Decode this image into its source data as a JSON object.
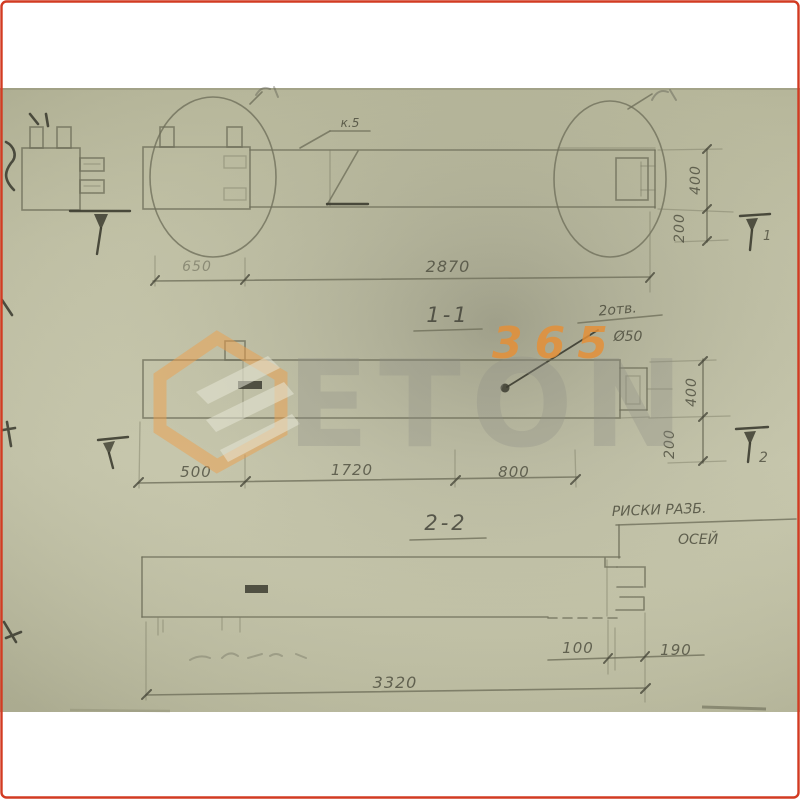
{
  "frame": {
    "border_color": "#d23b22"
  },
  "watermark": {
    "number": "365",
    "name": "ETON",
    "logo": "hexagon-logo",
    "accent_color": "#ee9f4b"
  },
  "elevation": {
    "callout_label": "к.5",
    "dim_left": "650",
    "dim_overall": "2870",
    "dim_height": "400",
    "dim_offset": "200",
    "cut_marker": "1"
  },
  "section_1_1": {
    "title": "1-1",
    "hole_note_top": "2отв.",
    "hole_note_bottom": "Ø50",
    "dim_1": "500",
    "dim_2": "1720",
    "dim_3": "800",
    "dim_height": "400",
    "dim_offset": "200",
    "cut_marker": "2"
  },
  "section_2_2": {
    "title": "2-2",
    "note_top": "РИСКИ РАЗБ.",
    "note_bottom": "ОСЕЙ",
    "dim_a": "100",
    "dim_b": "190",
    "dim_overall": "3320"
  }
}
